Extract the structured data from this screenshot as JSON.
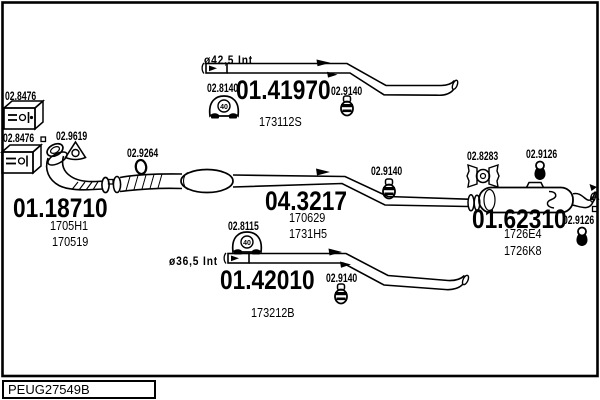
{
  "footer": {
    "code": "PEUG27549B"
  },
  "parts": {
    "front_pipe": {
      "number": "01.18710",
      "ref1": "1705H1",
      "ref2": "170519"
    },
    "top_pipe": {
      "number": "01.41970",
      "ref": "173112S",
      "diameter": "ø42,5 Int"
    },
    "center_pipe": {
      "number": "04.3217",
      "ref1": "170629",
      "ref2": "1731H5"
    },
    "bottom_pipe": {
      "number": "01.42010",
      "ref": "173212B",
      "diameter": "ø36,5 Int"
    },
    "rear_silencer": {
      "number": "01.62310",
      "ref1": "1726E4",
      "ref2": "1726K8"
    }
  },
  "labels": {
    "gasket_box_1": "02.8476",
    "gasket_box_2": "02.8476",
    "flange_gasket": "02.9619",
    "seal_ring": "02.9264",
    "mount_top": "02.8140",
    "clamp_top": "02.9140",
    "clamp_center": "02.9140",
    "clamp_bottom": "02.9140",
    "mount_center": "02.8115",
    "bracket_rear": "02.8283",
    "hanger_rear_upper": "02.9126",
    "hanger_rear_lower": "02.9126",
    "marker_a": "A",
    "mount_size": "40"
  },
  "colors": {
    "ink": "#000000",
    "background": "#ffffff"
  }
}
